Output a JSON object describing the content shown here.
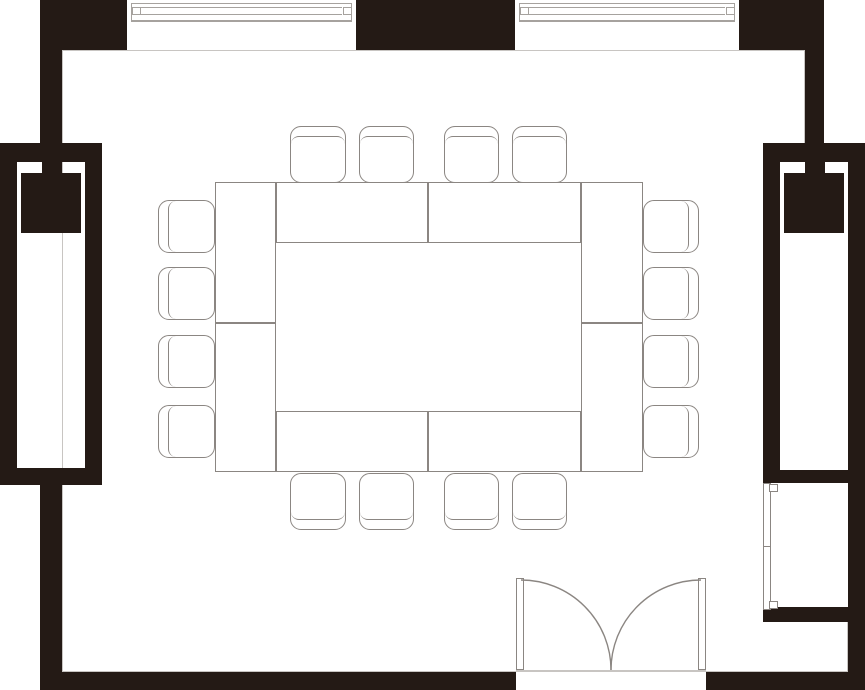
{
  "meta": {
    "title": "Meeting room floor plan",
    "summary": {
      "tables": 8,
      "chairs": 16,
      "windows": 2,
      "double_doors": 1,
      "closets": 2,
      "wall_panels": 1
    }
  },
  "canvas": {
    "width": 865,
    "height": 690
  },
  "colors": {
    "wall": "#241a15",
    "line": "#8b8682",
    "line_light": "#a6a29e",
    "hairline": "#c8c5c2",
    "floor": "#ffffff"
  },
  "walls": [
    {
      "name": "wall-top-left",
      "rect": [
        40,
        0,
        87,
        50
      ]
    },
    {
      "name": "wall-top-center",
      "rect": [
        356,
        0,
        159,
        50
      ]
    },
    {
      "name": "wall-top-right",
      "rect": [
        739,
        0,
        85,
        50
      ]
    },
    {
      "name": "wall-left-upper",
      "rect": [
        40,
        50,
        22,
        93
      ]
    },
    {
      "name": "wall-left-lower",
      "rect": [
        40,
        485,
        22,
        187
      ]
    },
    {
      "name": "wall-right-upper",
      "rect": [
        805,
        50,
        19,
        93
      ]
    },
    {
      "name": "wall-right-side",
      "rect": [
        848,
        143,
        17,
        529
      ]
    },
    {
      "name": "wall-bottom-left",
      "rect": [
        40,
        672,
        476,
        18
      ]
    },
    {
      "name": "wall-bottom-right",
      "rect": [
        706,
        672,
        159,
        18
      ]
    },
    {
      "name": "closet-left-top",
      "rect": [
        0,
        143,
        102,
        19
      ]
    },
    {
      "name": "closet-left-side-outer",
      "rect": [
        0,
        143,
        17,
        342
      ]
    },
    {
      "name": "closet-left-side-inner",
      "rect": [
        85,
        143,
        17,
        342
      ]
    },
    {
      "name": "closet-left-bottom",
      "rect": [
        0,
        468,
        102,
        17
      ]
    },
    {
      "name": "closet-left-connector",
      "rect": [
        42,
        162,
        20,
        12
      ]
    },
    {
      "name": "closet-left-block",
      "rect": [
        21,
        173,
        60,
        60
      ]
    },
    {
      "name": "closet-right-top",
      "rect": [
        763,
        143,
        102,
        19
      ]
    },
    {
      "name": "closet-right-side-inner",
      "rect": [
        763,
        143,
        17,
        340
      ]
    },
    {
      "name": "closet-right-bottom",
      "rect": [
        763,
        470,
        85,
        13
      ]
    },
    {
      "name": "closet-right-connector",
      "rect": [
        805,
        162,
        20,
        12
      ]
    },
    {
      "name": "closet-right-block",
      "rect": [
        784,
        173,
        60,
        60
      ]
    },
    {
      "name": "niche-bottom",
      "rect": [
        763,
        607,
        102,
        15
      ]
    }
  ],
  "hairlines": [
    {
      "name": "interior-edge-top",
      "rect": [
        62,
        50,
        743,
        1
      ]
    },
    {
      "name": "interior-edge-left",
      "rect": [
        62,
        50,
        1,
        622
      ]
    },
    {
      "name": "interior-edge-bottom",
      "rect": [
        62,
        671,
        786,
        1
      ]
    },
    {
      "name": "interior-edge-right-upper",
      "rect": [
        804,
        50,
        1,
        93
      ]
    },
    {
      "name": "interior-edge-right-lower",
      "rect": [
        847,
        622,
        1,
        50
      ]
    }
  ],
  "windows": [
    {
      "name": "window-1",
      "opening": [
        127,
        0,
        229,
        50
      ],
      "glazing": [
        131,
        3,
        221,
        18
      ],
      "glasslines": [
        [
          141,
          7,
          201
        ],
        [
          141,
          14,
          201
        ]
      ],
      "tabs": [
        [
          132,
          7,
          9,
          8
        ],
        [
          343,
          7,
          9,
          8
        ]
      ],
      "sill": [
        131,
        21,
        221
      ]
    },
    {
      "name": "window-2",
      "opening": [
        515,
        0,
        224,
        50
      ],
      "glazing": [
        519,
        3,
        216,
        18
      ],
      "glasslines": [
        [
          529,
          7,
          196
        ],
        [
          529,
          14,
          196
        ]
      ],
      "tabs": [
        [
          520,
          7,
          9,
          8
        ],
        [
          726,
          7,
          9,
          8
        ]
      ],
      "sill": [
        519,
        21,
        216
      ]
    }
  ],
  "tables": [
    {
      "name": "table-left-1",
      "rect": [
        215,
        182,
        61,
        141
      ]
    },
    {
      "name": "table-left-2",
      "rect": [
        215,
        323,
        61,
        149
      ]
    },
    {
      "name": "table-right-1",
      "rect": [
        581,
        182,
        62,
        141
      ]
    },
    {
      "name": "table-right-2",
      "rect": [
        581,
        323,
        62,
        149
      ]
    },
    {
      "name": "table-top-1",
      "rect": [
        276,
        182,
        152,
        61
      ]
    },
    {
      "name": "table-top-2",
      "rect": [
        428,
        182,
        153,
        61
      ]
    },
    {
      "name": "table-bottom-1",
      "rect": [
        276,
        411,
        152,
        61
      ]
    },
    {
      "name": "table-bottom-2",
      "rect": [
        428,
        411,
        153,
        61
      ]
    }
  ],
  "chairs": [
    {
      "name": "chair-top-1",
      "rect": [
        290,
        126,
        56,
        57
      ],
      "back": "top"
    },
    {
      "name": "chair-top-2",
      "rect": [
        359,
        126,
        55,
        57
      ],
      "back": "top"
    },
    {
      "name": "chair-top-3",
      "rect": [
        444,
        126,
        55,
        57
      ],
      "back": "top"
    },
    {
      "name": "chair-top-4",
      "rect": [
        512,
        126,
        55,
        57
      ],
      "back": "top"
    },
    {
      "name": "chair-bottom-1",
      "rect": [
        290,
        473,
        56,
        57
      ],
      "back": "bottom"
    },
    {
      "name": "chair-bottom-2",
      "rect": [
        359,
        473,
        55,
        57
      ],
      "back": "bottom"
    },
    {
      "name": "chair-bottom-3",
      "rect": [
        444,
        473,
        55,
        57
      ],
      "back": "bottom"
    },
    {
      "name": "chair-bottom-4",
      "rect": [
        512,
        473,
        55,
        57
      ],
      "back": "bottom"
    },
    {
      "name": "chair-left-1",
      "rect": [
        158,
        200,
        57,
        53
      ],
      "back": "left"
    },
    {
      "name": "chair-left-2",
      "rect": [
        158,
        267,
        57,
        53
      ],
      "back": "left"
    },
    {
      "name": "chair-left-3",
      "rect": [
        158,
        335,
        57,
        53
      ],
      "back": "left"
    },
    {
      "name": "chair-left-4",
      "rect": [
        158,
        405,
        57,
        53
      ],
      "back": "left"
    },
    {
      "name": "chair-right-1",
      "rect": [
        643,
        200,
        56,
        53
      ],
      "back": "right"
    },
    {
      "name": "chair-right-2",
      "rect": [
        643,
        267,
        56,
        53
      ],
      "back": "right"
    },
    {
      "name": "chair-right-3",
      "rect": [
        643,
        335,
        56,
        53
      ],
      "back": "right"
    },
    {
      "name": "chair-right-4",
      "rect": [
        643,
        405,
        56,
        53
      ],
      "back": "right"
    }
  ],
  "door": {
    "name": "double-swing-door",
    "leaves": [
      {
        "name": "door-leaf-left",
        "rect": [
          516,
          578,
          8,
          92
        ]
      },
      {
        "name": "door-leaf-right",
        "rect": [
          698,
          578,
          8,
          92
        ]
      }
    ],
    "arcs": [
      {
        "name": "door-swing-arc-left",
        "d": "M 521 580 A 90 90 0 0 1 611 670"
      },
      {
        "name": "door-swing-arc-right",
        "d": "M 701 580 A 90 90 0 0 0 611 670"
      }
    ],
    "threshold": [
      516,
      670,
      190
    ]
  },
  "wall_panel": {
    "name": "wall-panel",
    "body": [
      763,
      483,
      8,
      127
    ],
    "tabs": [
      [
        769,
        484,
        9,
        8
      ],
      [
        769,
        601,
        9,
        8
      ]
    ],
    "tick": [
      763,
      546,
      8,
      1
    ]
  }
}
